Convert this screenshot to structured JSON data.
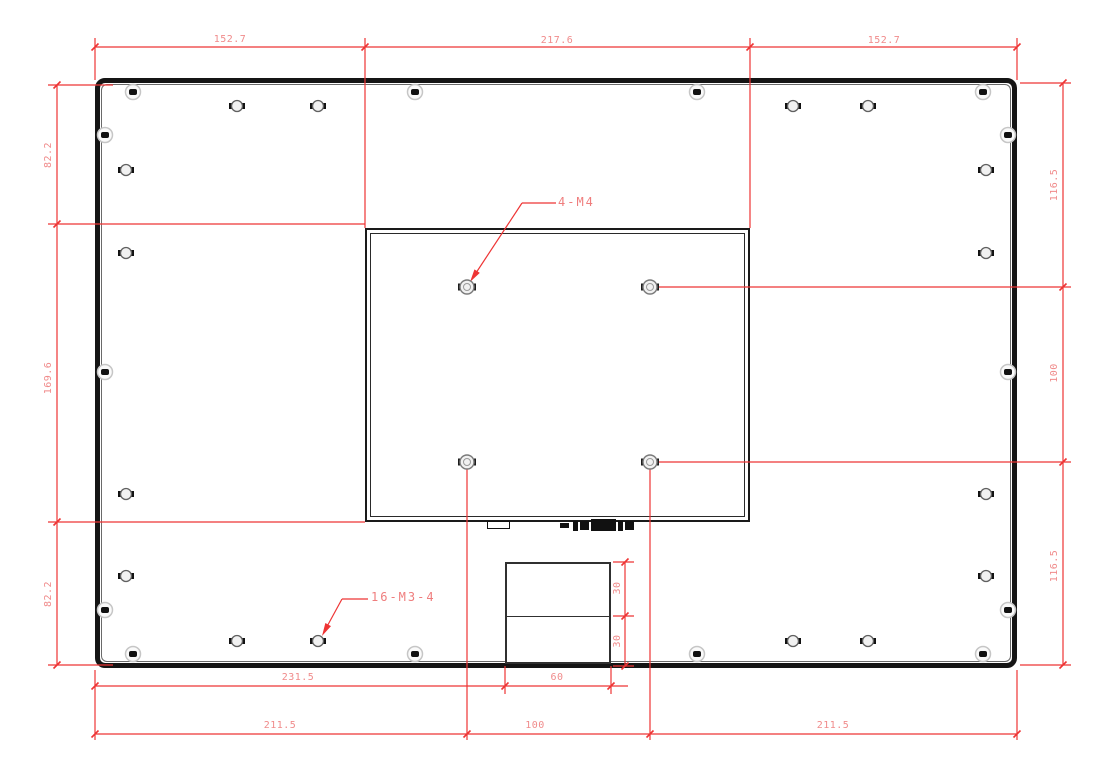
{
  "drawing": {
    "type": "mechanical-dimension-drawing",
    "view": "rear-panel-with-vesa-mount",
    "colors": {
      "background": "#ffffff",
      "outline": "#151515",
      "dimension_line": "#ee3434",
      "dimension_text": "#f08b8b"
    },
    "annotations": {
      "vesa_label": "4-M4",
      "mount_label": "16-M3-4"
    },
    "dims": {
      "top_left": "152.7",
      "top_center": "217.6",
      "top_right": "152.7",
      "left_top": "82.2",
      "left_middle": "169.6",
      "left_bottom": "82.2",
      "right_top": "116.5",
      "right_middle": "100",
      "right_bottom": "116.5",
      "bottom_inner_left": "231.5",
      "bottom_inner_box": "60",
      "bottom_outer_left": "211.5",
      "bottom_outer_center": "100",
      "bottom_outer_right": "211.5",
      "box_upper": "30",
      "box_lower": "30"
    },
    "holes": {
      "vesa_m4": [
        [
          467,
          287
        ],
        [
          650,
          287
        ],
        [
          467,
          462
        ],
        [
          650,
          462
        ]
      ],
      "mount_m3": [
        [
          237,
          106
        ],
        [
          318,
          106
        ],
        [
          793,
          106
        ],
        [
          868,
          106
        ],
        [
          126,
          170
        ],
        [
          126,
          253
        ],
        [
          126,
          494
        ],
        [
          126,
          576
        ],
        [
          986,
          170
        ],
        [
          986,
          253
        ],
        [
          986,
          494
        ],
        [
          986,
          576
        ],
        [
          237,
          641
        ],
        [
          318,
          641
        ],
        [
          793,
          641
        ],
        [
          868,
          641
        ]
      ],
      "edge_screws": [
        [
          133,
          92
        ],
        [
          415,
          92
        ],
        [
          697,
          92
        ],
        [
          983,
          92
        ],
        [
          105,
          135
        ],
        [
          105,
          372
        ],
        [
          105,
          610
        ],
        [
          1008,
          135
        ],
        [
          1008,
          372
        ],
        [
          1008,
          610
        ],
        [
          133,
          654
        ],
        [
          415,
          654
        ],
        [
          697,
          654
        ],
        [
          983,
          654
        ]
      ]
    }
  }
}
